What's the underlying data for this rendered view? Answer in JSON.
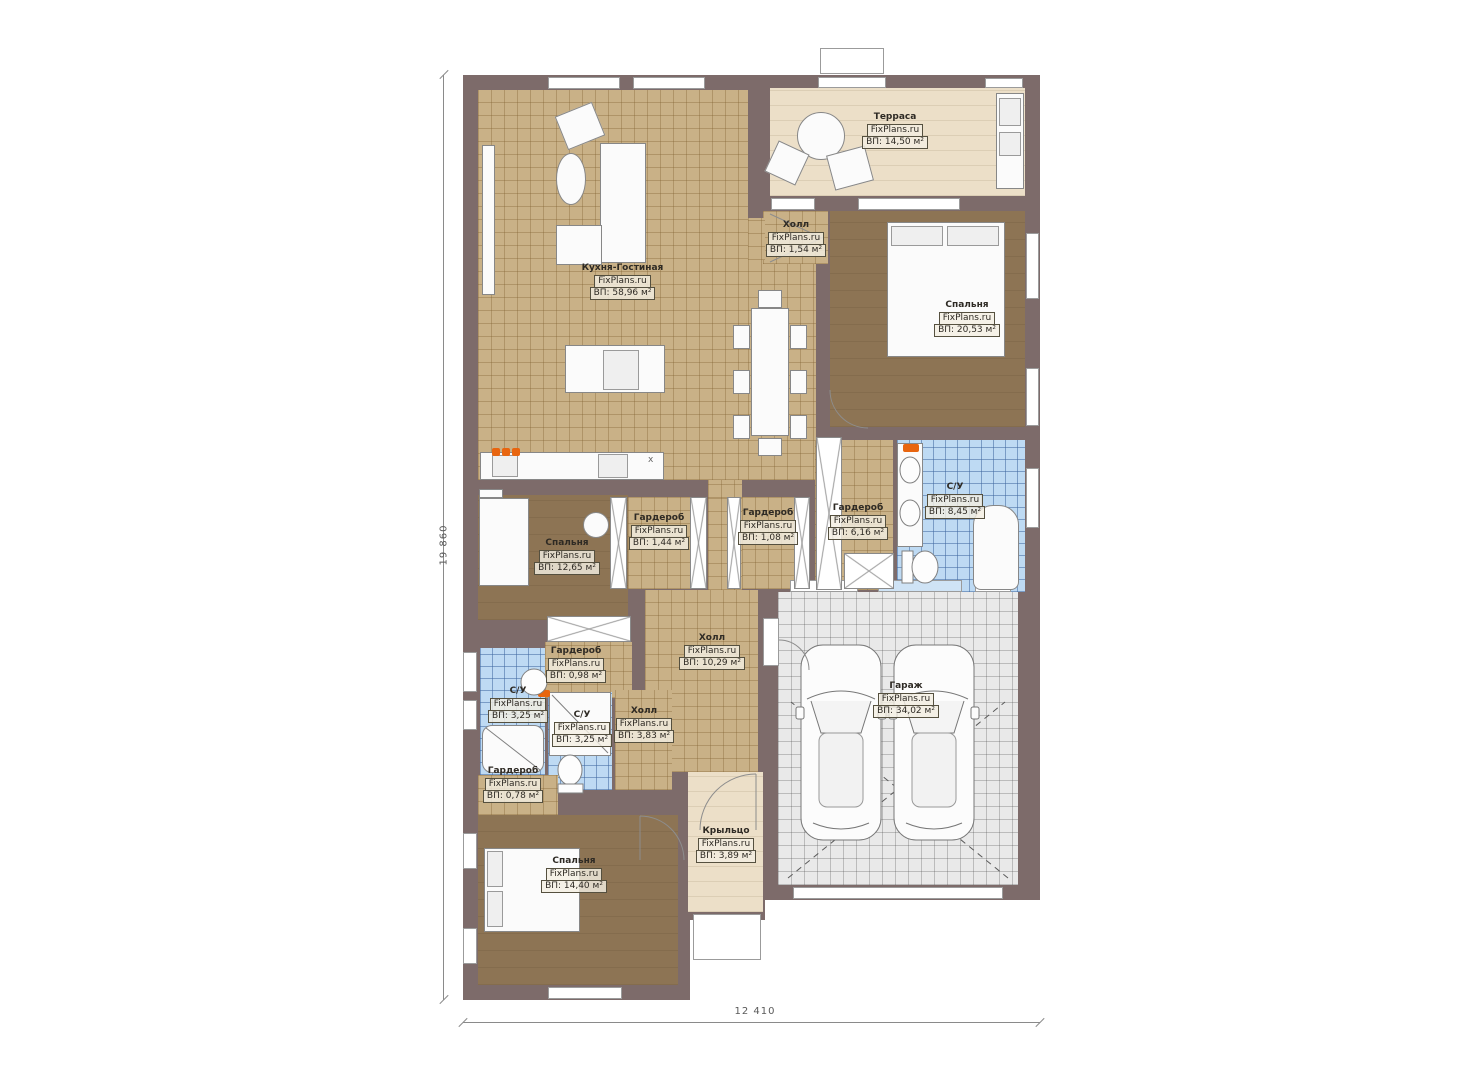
{
  "brand": "FixPlans.ru",
  "dimensions": {
    "vertical": "19 860",
    "horizontal": "12 410"
  },
  "colors": {
    "wall": "#7d6b6a",
    "floor_wood": "#c9b187",
    "floor_bedroom": "#8d7454",
    "floor_tile_blue": "#bedaf3",
    "floor_garage": "#e9e9e9",
    "floor_terrace": "#ecdfc8",
    "accent_orange": "#e8650f"
  },
  "icons": {
    "sink_cross": "x"
  },
  "rooms": [
    {
      "name": "Терраса",
      "area": "ВП: 14,50 м²"
    },
    {
      "name": "Холл",
      "area": "ВП: 1,54 м²"
    },
    {
      "name": "Кухня-Гостиная",
      "area": "ВП: 58,96 м²"
    },
    {
      "name": "Спальня",
      "area": "ВП: 20,53 м²"
    },
    {
      "name": "С/У",
      "area": "ВП: 8,45 м²"
    },
    {
      "name": "Гардероб",
      "area": "ВП: 1,44 м²"
    },
    {
      "name": "Гардероб",
      "area": "ВП: 1,08 м²"
    },
    {
      "name": "Гардероб",
      "area": "ВП: 6,16 м²"
    },
    {
      "name": "Спальня",
      "area": "ВП: 12,65 м²"
    },
    {
      "name": "Холл",
      "area": "ВП: 10,29 м²"
    },
    {
      "name": "Гардероб",
      "area": "ВП: 0,98 м²"
    },
    {
      "name": "С/У",
      "area": "ВП: 3,25 м²"
    },
    {
      "name": "С/У",
      "area": "ВП: 3,25 м²"
    },
    {
      "name": "Холл",
      "area": "ВП: 3,83 м²"
    },
    {
      "name": "Гардероб",
      "area": "ВП: 0,78 м²"
    },
    {
      "name": "Спальня",
      "area": "ВП: 14,40 м²"
    },
    {
      "name": "Крыльцо",
      "area": "ВП: 3,89 м²"
    },
    {
      "name": "Гараж",
      "area": "ВП: 34,02 м²"
    }
  ]
}
